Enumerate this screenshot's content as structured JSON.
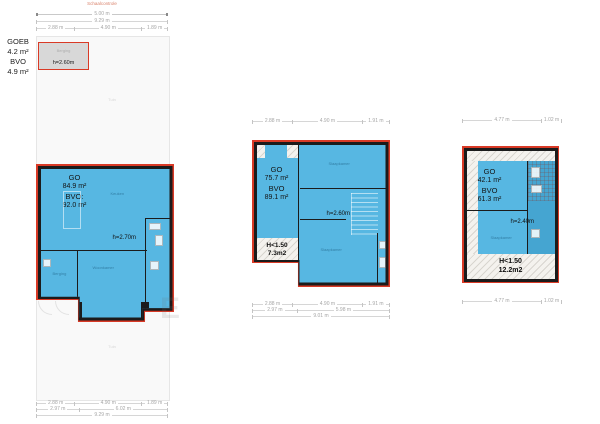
{
  "scale": {
    "label": "Schaalcontrole",
    "value": "5.00 m"
  },
  "watermark": "E",
  "ground_floor": {
    "outbuilding_summary": {
      "l1": "GOEB",
      "l2": "4.2 m²",
      "l3": "BVO",
      "l4": "4.9 m²"
    },
    "shed": {
      "room": "Berging",
      "height": "h=2.60m"
    },
    "garden_top": "Tuin",
    "garden_bottom": "Tuin",
    "summary": {
      "l1": "GO",
      "l2": "84.9 m²",
      "l3": "BVO:",
      "l4": "92.0 m²"
    },
    "height": "h=2.70m",
    "rooms": {
      "kitchen": "Keuken",
      "living": "Woonkamer",
      "storage": "Berging"
    },
    "dims": {
      "seg1": "2.88 m",
      "seg2": "4.90 m",
      "seg3": "1.89 m",
      "sub1": "2.97 m",
      "sub2": "6.02 m",
      "total": "9.29 m"
    }
  },
  "first_floor": {
    "summary": {
      "l1": "GO",
      "l2": "75.7 m²",
      "l3": "BVO",
      "l4": "89.1 m²"
    },
    "height": "h=2.60m",
    "low_headroom": {
      "l1": "H<1.50",
      "l2": "7.3m2"
    },
    "rooms": {
      "top": "Slaapkamer",
      "bottom": "Slaapkamer"
    },
    "dims": {
      "seg1": "2.88 m",
      "seg2": "4.90 m",
      "seg3": "1.91 m",
      "sub1": "2.97 m",
      "sub2": "5.98 m",
      "total": "9.01 m"
    }
  },
  "second_floor": {
    "summary": {
      "l1": "GO",
      "l2": "42.1 m²",
      "l3": "BVO",
      "l4": "61.3 m²"
    },
    "height": "h=2.40m",
    "low_headroom": {
      "l1": "H<1.50",
      "l2": "12.2m2"
    },
    "rooms": {
      "main": "Slaapkamer"
    },
    "dims": {
      "seg1": "4.77 m",
      "seg2": "1.02 m"
    }
  }
}
